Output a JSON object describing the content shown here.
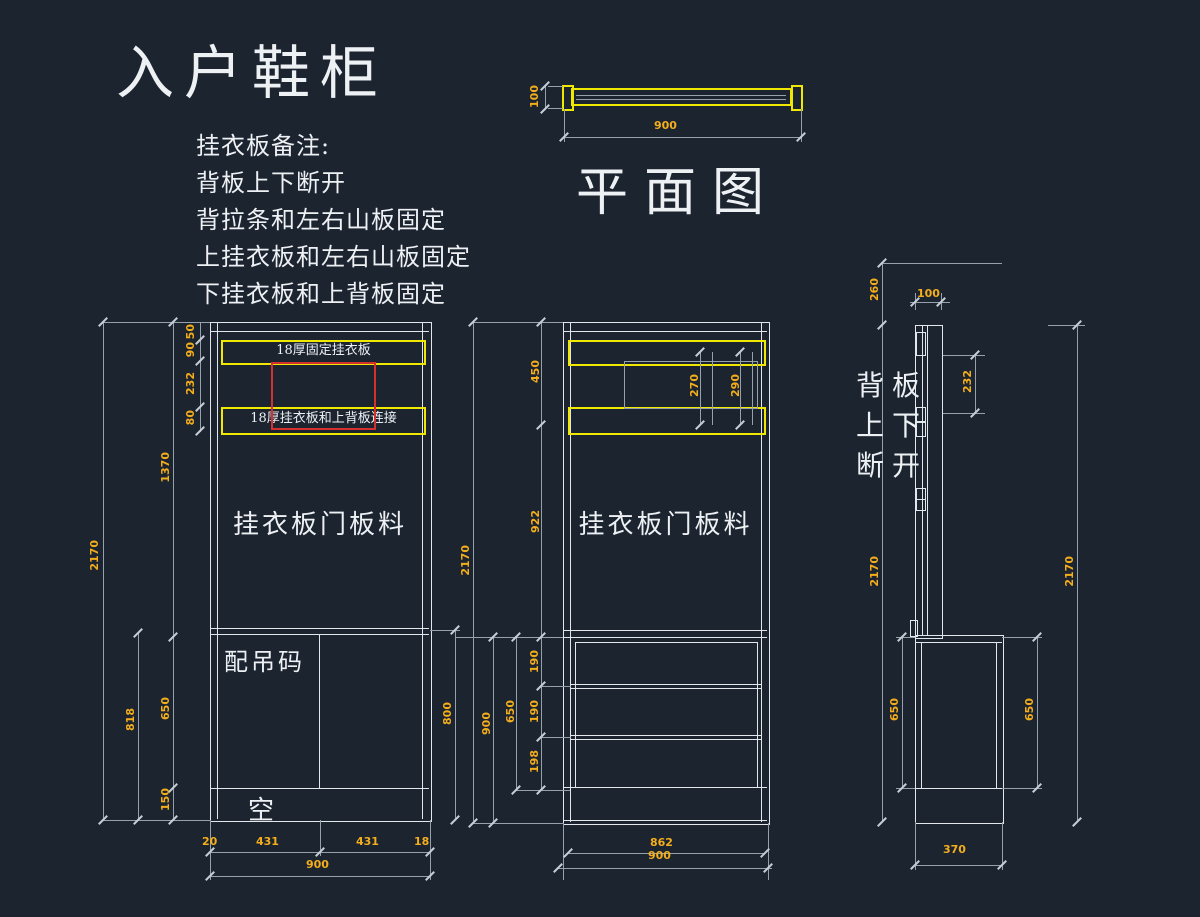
{
  "title": "入户鞋柜",
  "notes": [
    "挂衣板备注:",
    "背板上下断开",
    "背拉条和左右山板固定",
    "上挂衣板和左右山板固定",
    "下挂衣板和上背板固定"
  ],
  "plan": {
    "label": "平面图",
    "dim_width": "900",
    "dim_depth": "100"
  },
  "left_view": {
    "band_top_label": "18厚固定挂衣板",
    "band_bottom_label": "18厚挂衣板和上背板连接",
    "door_text": "挂衣板门板料",
    "hanger_text": "配吊码",
    "empty_text": "空",
    "dim_total": "2170",
    "dim_818": "818",
    "dim_upper": "1370",
    "dim_lower": "650",
    "dim_plinth": "150",
    "dim_50": "50",
    "dim_90": "90",
    "dim_232": "232",
    "dim_80": "80",
    "dim_right": "800",
    "dim_b20": "20",
    "dim_b431a": "431",
    "dim_b431b": "431",
    "dim_b18": "18",
    "dim_b900": "900"
  },
  "mid_view": {
    "door_text": "挂衣板门板料",
    "dim_total": "2170",
    "dim_450": "450",
    "dim_922": "922",
    "dim_lower": "900",
    "dim_650": "650",
    "dim_190a": "190",
    "dim_190b": "190",
    "dim_198": "198",
    "dim_270": "270",
    "dim_290": "290",
    "dim_b862": "862",
    "dim_b900": "900"
  },
  "side_view": {
    "note_lines": [
      "背板",
      "上下",
      "断开"
    ],
    "dim_260": "260",
    "dim_100": "100",
    "dim_232": "232",
    "dim_total_left": "2170",
    "dim_total_right": "2170",
    "dim_650_left": "650",
    "dim_650_right": "650",
    "dim_370": "370"
  },
  "colors": {
    "background": "#1c2430",
    "line_white": "#e3e6ea",
    "line_gray": "#97a1ac",
    "accent_yellow": "#f0e800",
    "dim_orange": "#f4ae1c",
    "highlight_red": "#d43030",
    "text_white": "#eef1f4"
  }
}
